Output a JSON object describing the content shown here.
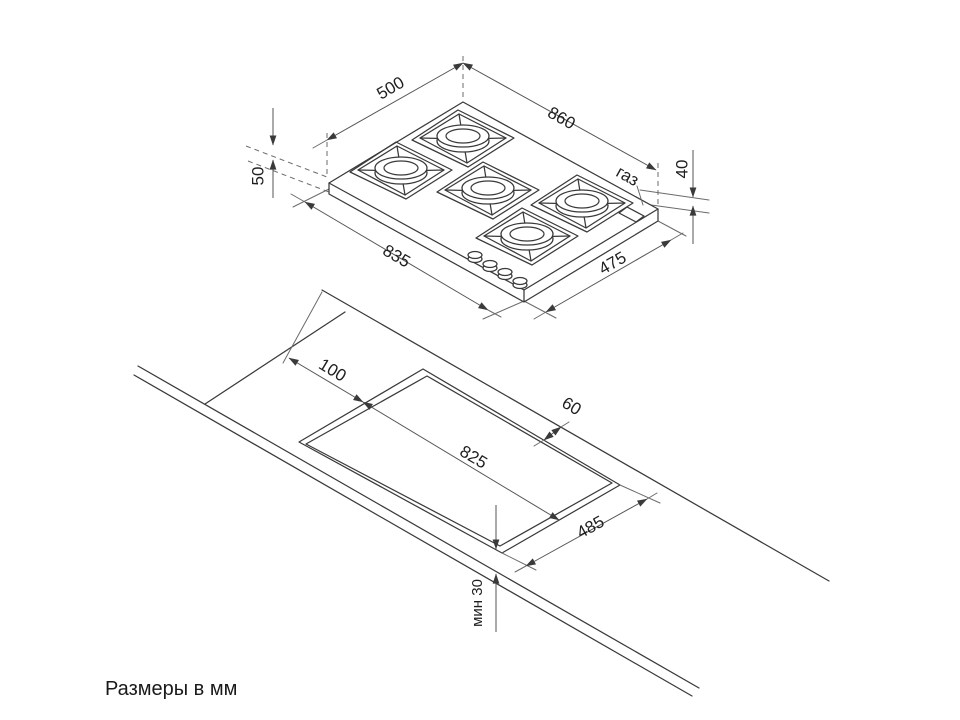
{
  "caption": "Размеры в мм",
  "hob": {
    "dim_top_width": "500",
    "dim_top_length": "860",
    "dim_height_left": "50",
    "dim_height_right": "40",
    "dim_body_length": "835",
    "dim_body_depth": "475",
    "gas_label": "газ"
  },
  "cutout": {
    "dim_side_offset": "100",
    "dim_length": "825",
    "dim_back_offset": "60",
    "dim_depth": "485",
    "dim_front_min": "мин 30"
  }
}
